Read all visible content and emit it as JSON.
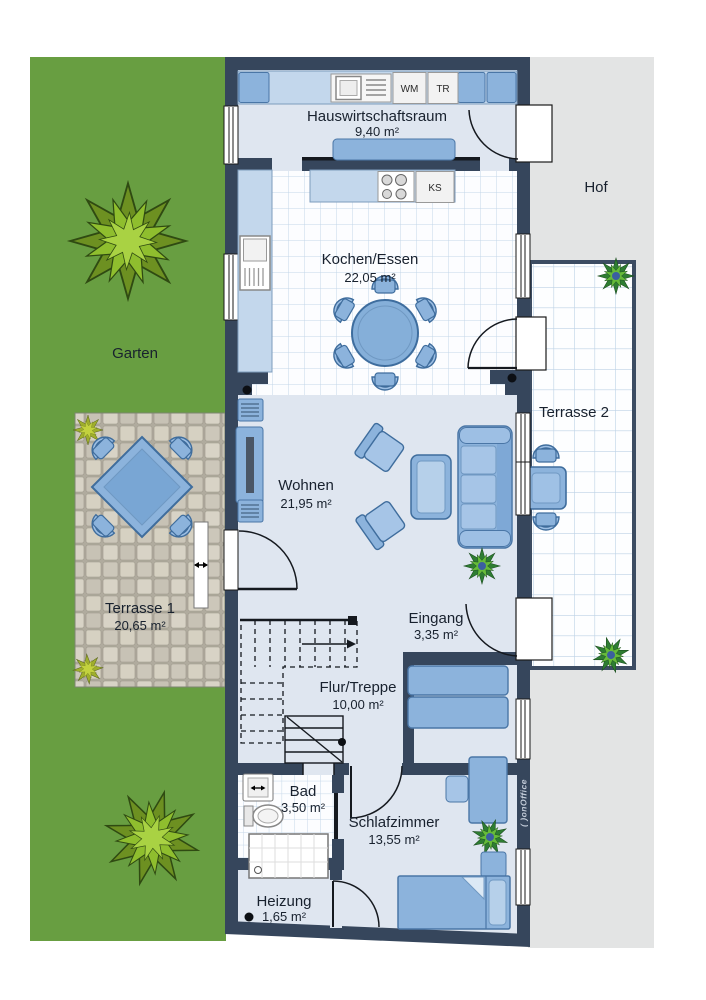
{
  "floorplan": {
    "outdoor": {
      "garden_label": "Garten",
      "yard_label": "Hof"
    },
    "rooms": {
      "utility": {
        "name": "Hauswirtschaftsraum",
        "area": "9,40 m²"
      },
      "kitchen_dining": {
        "name": "Kochen/Essen",
        "area": "22,05 m²"
      },
      "living": {
        "name": "Wohnen",
        "area": "21,95 m²"
      },
      "terrace1": {
        "name": "Terrasse 1",
        "area": "20,65 m²"
      },
      "terrace2": {
        "name": "Terrasse 2"
      },
      "entrance": {
        "name": "Eingang",
        "area": "3,35 m²"
      },
      "hallway_stairs": {
        "name": "Flur/Treppe",
        "area": "10,00 m²"
      },
      "bathroom": {
        "name": "Bad",
        "area": "3,50 m²"
      },
      "bedroom": {
        "name": "Schlafzimmer",
        "area": "13,55 m²"
      },
      "heating": {
        "name": "Heizung",
        "area": "1,65 m²"
      }
    },
    "appliances": {
      "washing_machine": "WM",
      "dryer": "TR",
      "fridge": "KS"
    },
    "branding": {
      "watermark": "( )onOffice"
    },
    "colors": {
      "wall": "#36465c",
      "floor": "#dfe6f0",
      "furniture": "#8cb3dc",
      "furniture_light": "#a6c5e7",
      "counter": "#c3d7ec",
      "garden": "#689e41",
      "yard": "#e3e4e4",
      "tile_line": "#c3d6e8"
    }
  }
}
